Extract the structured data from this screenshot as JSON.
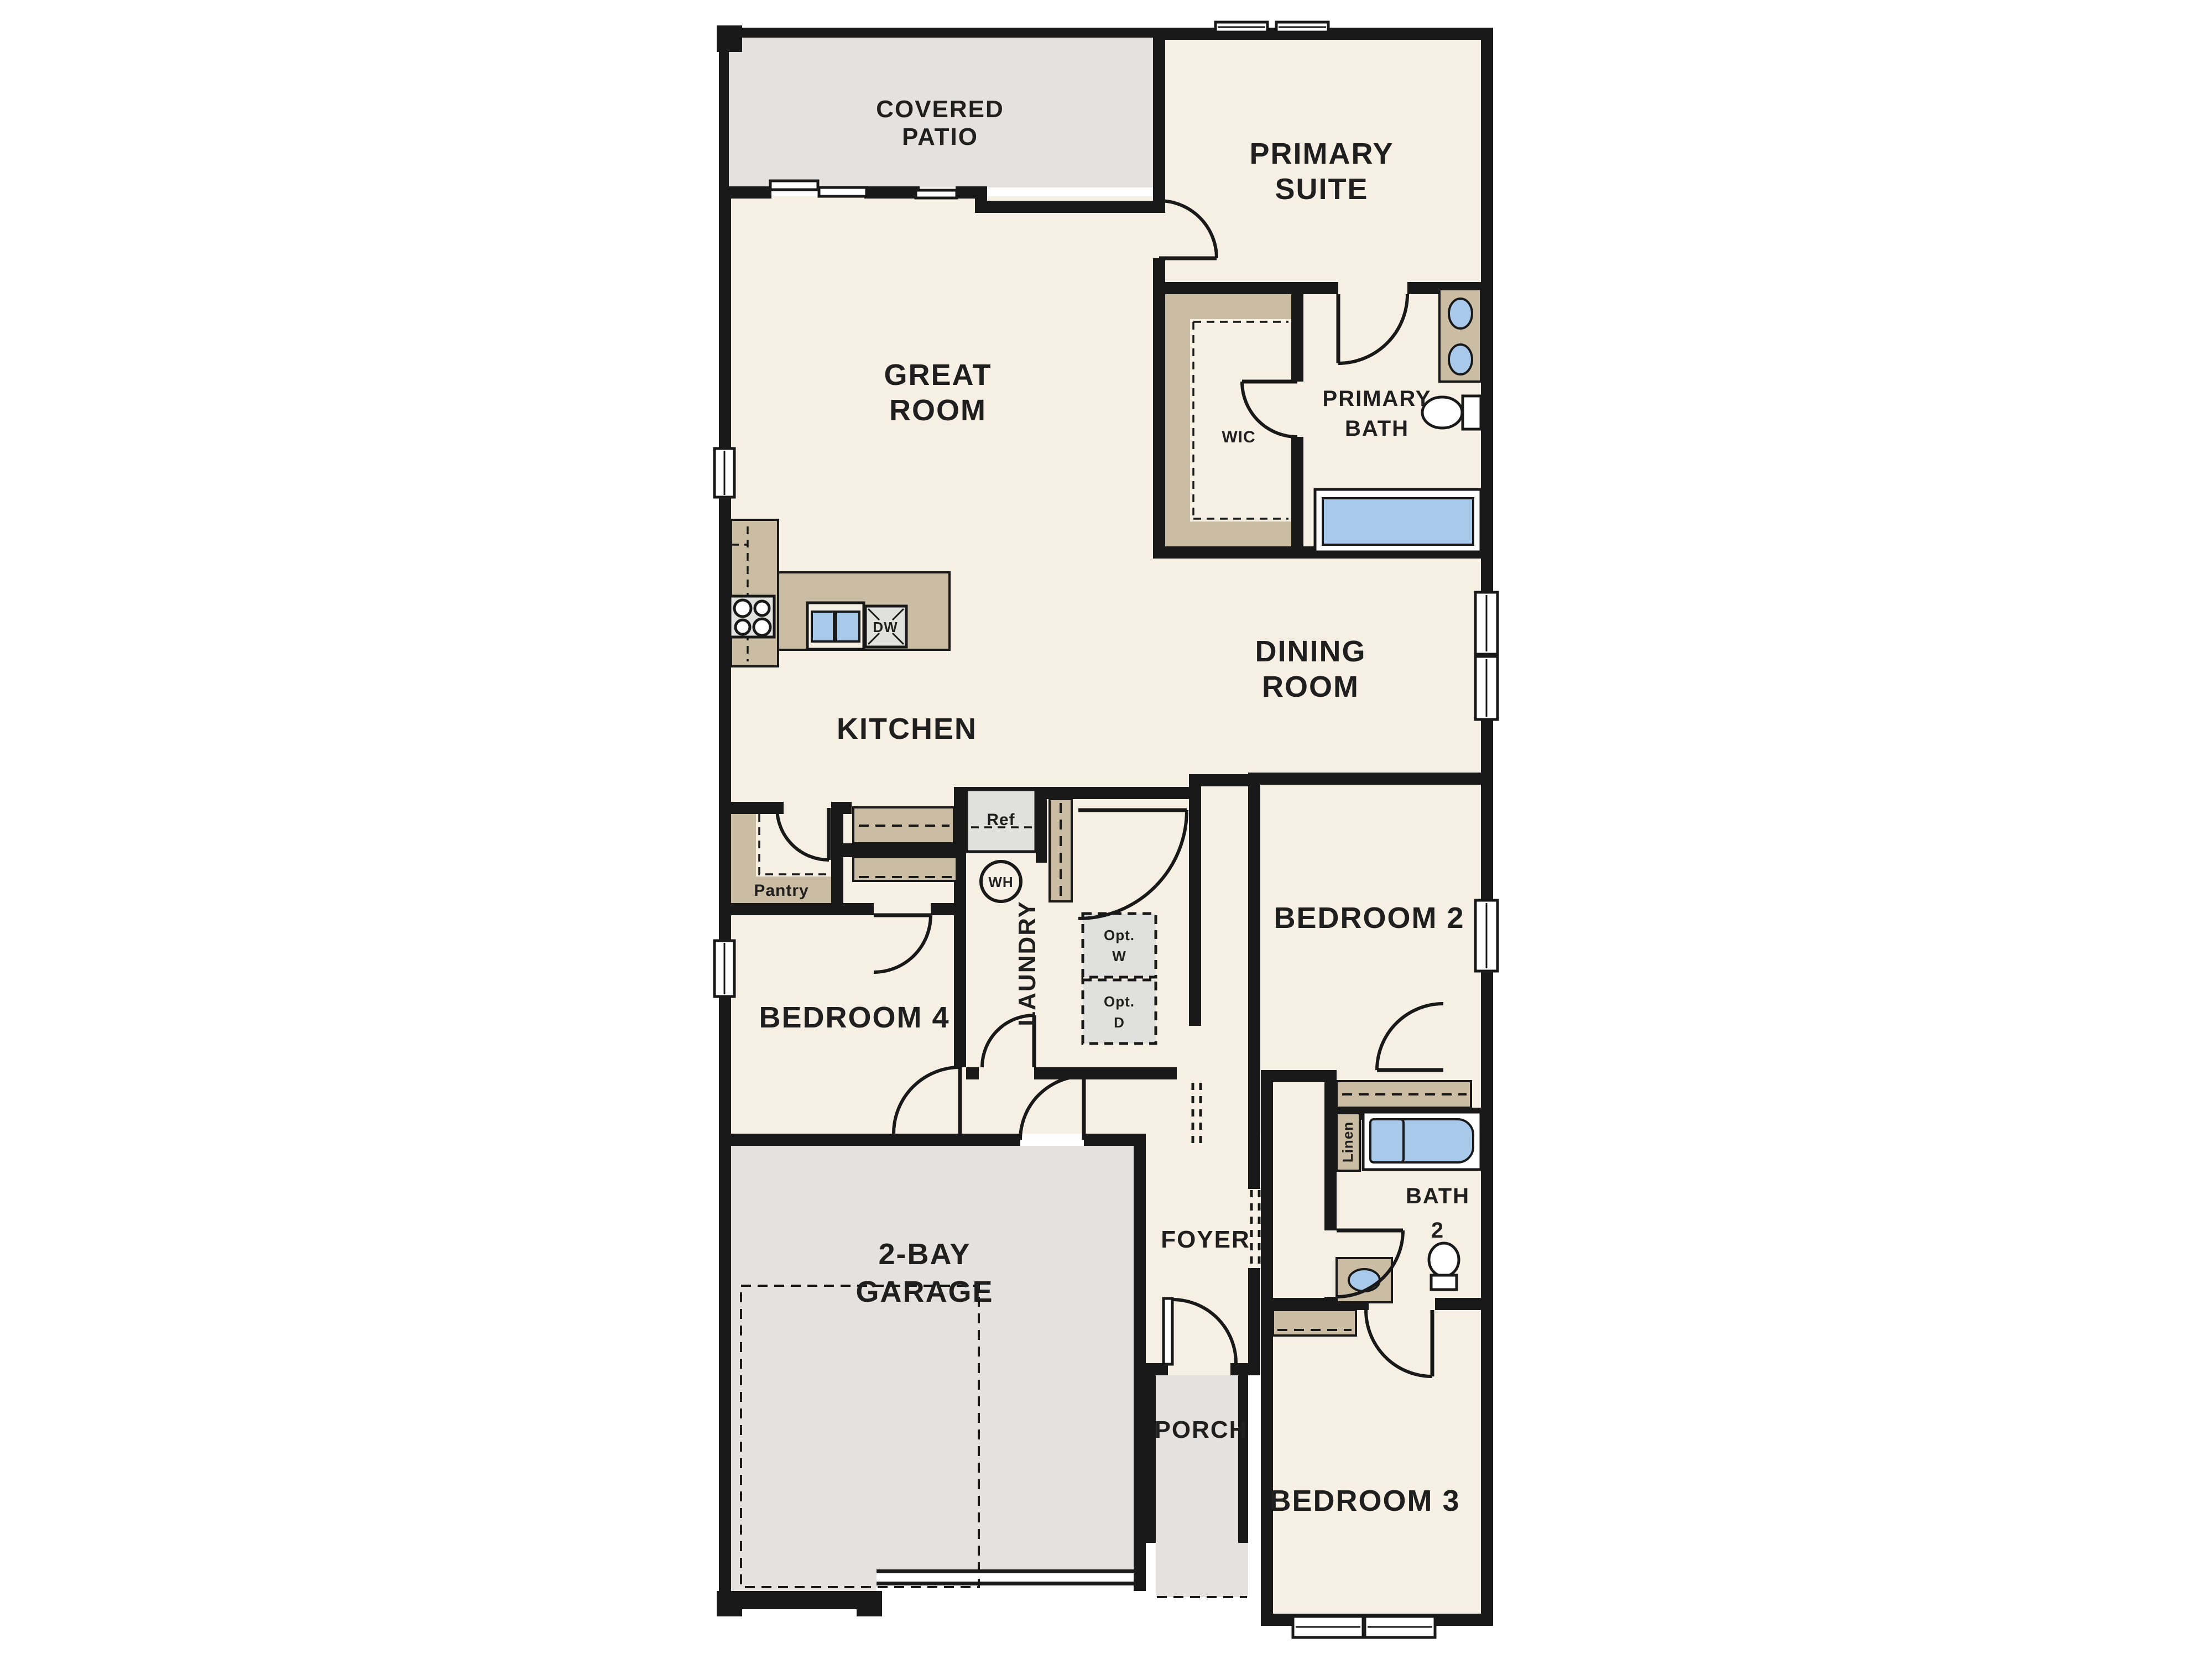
{
  "colors": {
    "wall": "#191919",
    "room": "#f6efe3",
    "outdoor": "#e3e2e0",
    "casework": "#cbbda4",
    "appliance": "#e0e0de",
    "fixture": "#a9c9ea",
    "text": "#1f1f1f"
  },
  "plan": {
    "rooms": {
      "covered_patio": {
        "line1": "COVERED",
        "line2": "PATIO"
      },
      "primary_suite": {
        "line1": "PRIMARY",
        "line2": "SUITE"
      },
      "great_room": {
        "line1": "GREAT",
        "line2": "ROOM"
      },
      "wic": {
        "label": "WIC"
      },
      "primary_bath": {
        "line1": "PRIMARY",
        "line2": "BATH"
      },
      "kitchen": {
        "label": "KITCHEN"
      },
      "dining_room": {
        "line1": "DINING",
        "line2": "ROOM"
      },
      "bedroom2": {
        "label": "BEDROOM 2"
      },
      "bedroom4": {
        "label": "BEDROOM 4"
      },
      "laundry": {
        "label": "LAUNDRY"
      },
      "foyer": {
        "label": "FOYER"
      },
      "bath2": {
        "line1": "BATH",
        "line2": "2"
      },
      "porch": {
        "label": "PORCH"
      },
      "garage": {
        "line1": "2-BAY",
        "line2": "GARAGE"
      },
      "bedroom3": {
        "label": "BEDROOM 3"
      }
    },
    "fixtures": {
      "ref": {
        "label": "Ref"
      },
      "dw": {
        "label": "DW"
      },
      "wh": {
        "label": "WH"
      },
      "pantry": {
        "label": "Pantry"
      },
      "linen": {
        "label": "Linen"
      },
      "opt_w": {
        "line1": "Opt.",
        "line2": "W"
      },
      "opt_d": {
        "line1": "Opt.",
        "line2": "D"
      }
    }
  }
}
